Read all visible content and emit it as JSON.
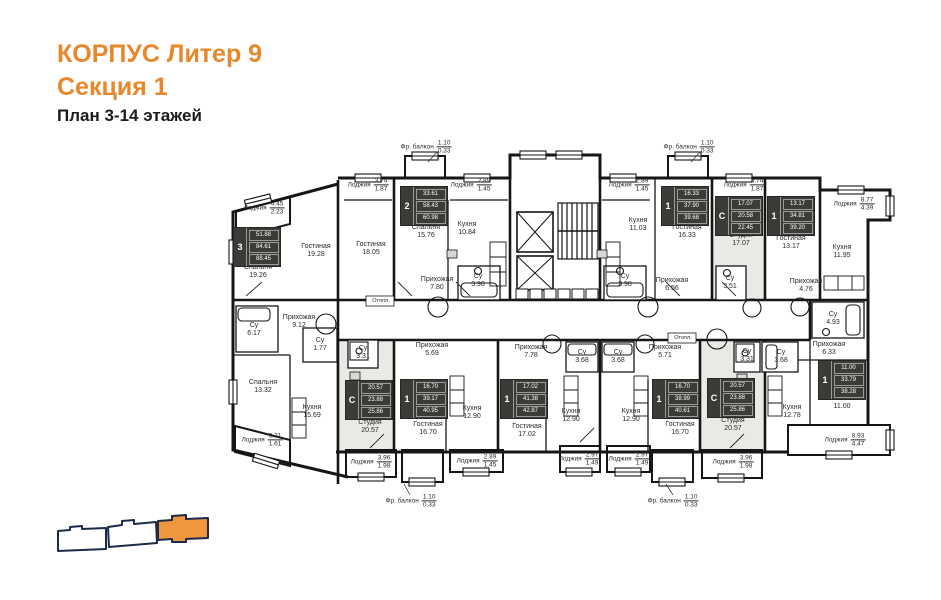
{
  "title": {
    "line1": "КОРПУС Литер 9",
    "line2": "Секция 1",
    "line3": "План 3-14 этажей"
  },
  "colors": {
    "accent": "#E8872B",
    "wall": "#161616",
    "studio_fill": "#EAE9E5",
    "keyplan_outline": "#1C2B4A",
    "keyplan_highlight": "#F0963C"
  },
  "plan": {
    "rooms": [
      {
        "n": "Спальня",
        "a": "19.26",
        "x": 258,
        "y": 272
      },
      {
        "n": "Гостиная",
        "a": "19.28",
        "x": 316,
        "y": 251
      },
      {
        "n": "Гостиная",
        "a": "18.05",
        "x": 371,
        "y": 249
      },
      {
        "n": "Спальня",
        "a": "15.76",
        "x": 426,
        "y": 232
      },
      {
        "n": "Кухня",
        "a": "10.84",
        "x": 467,
        "y": 229
      },
      {
        "n": "Прихожая",
        "a": "7.80",
        "x": 437,
        "y": 284
      },
      {
        "n": "Су",
        "a": "3.98",
        "x": 478,
        "y": 281
      },
      {
        "n": "Кухня",
        "a": "11.03",
        "x": 638,
        "y": 225
      },
      {
        "n": "Су",
        "a": "3.98",
        "x": 625,
        "y": 281
      },
      {
        "n": "Прихожая",
        "a": "6.56",
        "x": 672,
        "y": 285
      },
      {
        "n": "Гостиная",
        "a": "16.33",
        "x": 687,
        "y": 232
      },
      {
        "n": "Студия",
        "a": "17.07",
        "x": 741,
        "y": 240
      },
      {
        "n": "Су",
        "a": "3.51",
        "x": 730,
        "y": 283
      },
      {
        "n": "Гостиная",
        "a": "13.17",
        "x": 791,
        "y": 243
      },
      {
        "n": "Кухня",
        "a": "11.95",
        "x": 842,
        "y": 252
      },
      {
        "n": "Прихожая",
        "a": "4.76",
        "x": 806,
        "y": 286
      },
      {
        "n": "Су",
        "a": "4.93",
        "x": 833,
        "y": 319
      },
      {
        "n": "Прихожая",
        "a": "6.33",
        "x": 829,
        "y": 349
      },
      {
        "n": "Су",
        "a": "6.17",
        "x": 254,
        "y": 330
      },
      {
        "n": "Прихожая",
        "a": "9.12",
        "x": 299,
        "y": 322
      },
      {
        "n": "Су",
        "a": "1.77",
        "x": 320,
        "y": 345
      },
      {
        "n": "Спальня",
        "a": "13.32",
        "x": 263,
        "y": 387
      },
      {
        "n": "Кухня",
        "a": "15.69",
        "x": 312,
        "y": 412
      },
      {
        "n": "Су",
        "a": "3.31",
        "x": 363,
        "y": 353
      },
      {
        "n": "Студия",
        "a": "20.57",
        "x": 370,
        "y": 427
      },
      {
        "n": "Прихожая",
        "a": "5.69",
        "x": 432,
        "y": 350
      },
      {
        "n": "Гостиная",
        "a": "16.70",
        "x": 428,
        "y": 429
      },
      {
        "n": "Кухня",
        "a": "12.90",
        "x": 472,
        "y": 413
      },
      {
        "n": "Прихожая",
        "a": "7.78",
        "x": 531,
        "y": 352
      },
      {
        "n": "Су",
        "a": "3.68",
        "x": 582,
        "y": 357
      },
      {
        "n": "Су",
        "a": "3.68",
        "x": 618,
        "y": 357
      },
      {
        "n": "Гостиная",
        "a": "17.02",
        "x": 527,
        "y": 431
      },
      {
        "n": "Кухня",
        "a": "12.90",
        "x": 571,
        "y": 416
      },
      {
        "n": "Кухня",
        "a": "12.90",
        "x": 631,
        "y": 416
      },
      {
        "n": "Прихожая",
        "a": "5.71",
        "x": 665,
        "y": 352
      },
      {
        "n": "Гостиная",
        "a": "16.70",
        "x": 680,
        "y": 429
      },
      {
        "n": "Су",
        "a": "3.31",
        "x": 747,
        "y": 356
      },
      {
        "n": "Су",
        "a": "3.68",
        "x": 781,
        "y": 357
      },
      {
        "n": "Студия",
        "a": "20.57",
        "x": 733,
        "y": 425
      },
      {
        "n": "Кухня",
        "a": "12.78",
        "x": 792,
        "y": 412
      },
      {
        "n": "Спальня",
        "a": "11.00",
        "x": 842,
        "y": 403
      }
    ],
    "loggias": [
      {
        "n": "Лоджия",
        "top": "4.45",
        "bot": "2.23",
        "x": 264,
        "y": 208
      },
      {
        "n": "Лоджия",
        "top": "3.74",
        "bot": "1.87",
        "x": 368,
        "y": 185
      },
      {
        "n": "Фр. балкон",
        "top": "1.10",
        "bot": "0.33",
        "x": 426,
        "y": 147
      },
      {
        "n": "Лоджия",
        "top": "2.89",
        "bot": "1.45",
        "x": 471,
        "y": 185
      },
      {
        "n": "Лоджия",
        "top": "2.89",
        "bot": "1.45",
        "x": 629,
        "y": 185
      },
      {
        "n": "Фр. балкон",
        "top": "1.10",
        "bot": "0.33",
        "x": 689,
        "y": 147
      },
      {
        "n": "Лоджия",
        "top": "3.74",
        "bot": "1.87",
        "x": 744,
        "y": 185
      },
      {
        "n": "Лоджия",
        "top": "8.77",
        "bot": "4.39",
        "x": 854,
        "y": 204
      },
      {
        "n": "Лоджия",
        "top": "3.21",
        "bot": "1.61",
        "x": 262,
        "y": 440
      },
      {
        "n": "Лоджия",
        "top": "3.96",
        "bot": "1.98",
        "x": 371,
        "y": 462
      },
      {
        "n": "Лоджия",
        "top": "2.89",
        "bot": "1.45",
        "x": 477,
        "y": 461
      },
      {
        "n": "Лоджия",
        "top": "2.97",
        "bot": "1.49",
        "x": 579,
        "y": 459
      },
      {
        "n": "Лоджия",
        "top": "2.97",
        "bot": "1.49",
        "x": 629,
        "y": 459
      },
      {
        "n": "Лоджия",
        "top": "3.96",
        "bot": "1.98",
        "x": 733,
        "y": 462
      },
      {
        "n": "Лоджия",
        "top": "8.93",
        "bot": "4.47",
        "x": 845,
        "y": 440
      },
      {
        "n": "Фр. балкон",
        "top": "1.10",
        "bot": "0.33",
        "x": 411,
        "y": 501
      },
      {
        "n": "Фр. балкон",
        "top": "1.10",
        "bot": "0.33",
        "x": 673,
        "y": 501
      }
    ],
    "badges": [
      {
        "r": "3",
        "v": [
          "51.88",
          "84.61",
          "88.45"
        ],
        "x": 257,
        "y": 247
      },
      {
        "r": "2",
        "v": [
          "33.61",
          "58.43",
          "60.98"
        ],
        "x": 424,
        "y": 206
      },
      {
        "r": "1",
        "v": [
          "16.33",
          "37.90",
          "39.68"
        ],
        "x": 685,
        "y": 206
      },
      {
        "r": "С",
        "v": [
          "17.07",
          "20.58",
          "22.45"
        ],
        "x": 739,
        "y": 216
      },
      {
        "r": "1",
        "v": [
          "13.17",
          "34.81",
          "39.20"
        ],
        "x": 791,
        "y": 216
      },
      {
        "r": "С",
        "v": [
          "20.57",
          "23.88",
          "25.86"
        ],
        "x": 369,
        "y": 400
      },
      {
        "r": "1",
        "v": [
          "16.70",
          "39.17",
          "40.95"
        ],
        "x": 424,
        "y": 399
      },
      {
        "r": "1",
        "v": [
          "17.02",
          "41.38",
          "42.87"
        ],
        "x": 524,
        "y": 399
      },
      {
        "r": "1",
        "v": [
          "16.70",
          "38.99",
          "40.61"
        ],
        "x": 676,
        "y": 399
      },
      {
        "r": "С",
        "v": [
          "20.57",
          "23.88",
          "25.86"
        ],
        "x": 731,
        "y": 398
      },
      {
        "r": "1",
        "v": [
          "11.00",
          "33.79",
          "38.28"
        ],
        "x": 842,
        "y": 380
      }
    ],
    "small": [
      {
        "t": "Отопл.",
        "x": 381,
        "y": 301
      },
      {
        "t": "Отопл.",
        "x": 683,
        "y": 338
      }
    ]
  },
  "keyplan": {
    "sections": [
      {
        "id": "left",
        "highlighted": false
      },
      {
        "id": "middle",
        "highlighted": false
      },
      {
        "id": "right",
        "highlighted": true
      }
    ]
  }
}
